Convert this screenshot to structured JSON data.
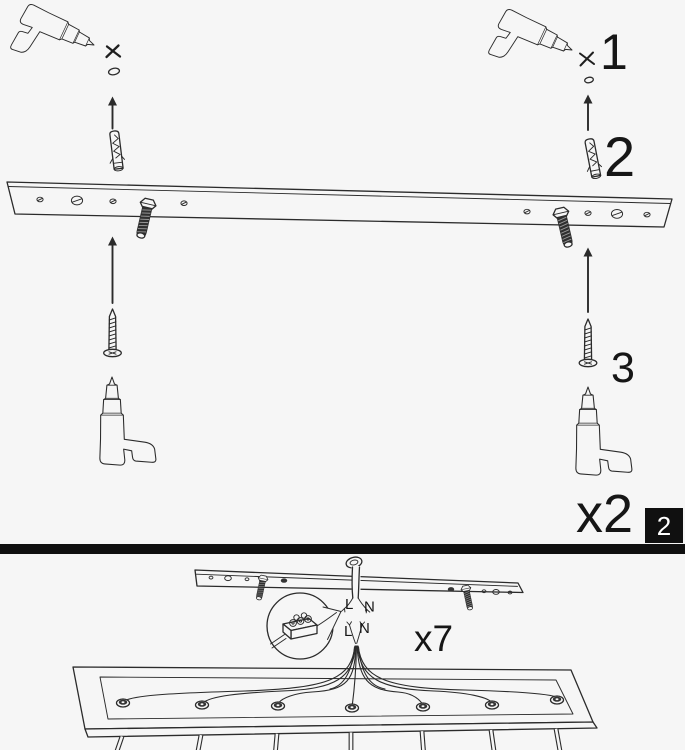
{
  "top_panel": {
    "callouts": {
      "step1": "1",
      "step2": "2",
      "step3": "3"
    },
    "quantity": "x2",
    "page_badge": "2"
  },
  "bottom_panel": {
    "quantity": "x7",
    "wire_labels": {
      "top_live": "L",
      "top_neutral": "N",
      "bottom_live": "L",
      "bottom_neutral": "N"
    }
  },
  "colors": {
    "background": "#f6f6f6",
    "line": "#2b2b2b",
    "divider": "#101010",
    "badge_background": "#101010",
    "badge_text": "#ffffff"
  }
}
